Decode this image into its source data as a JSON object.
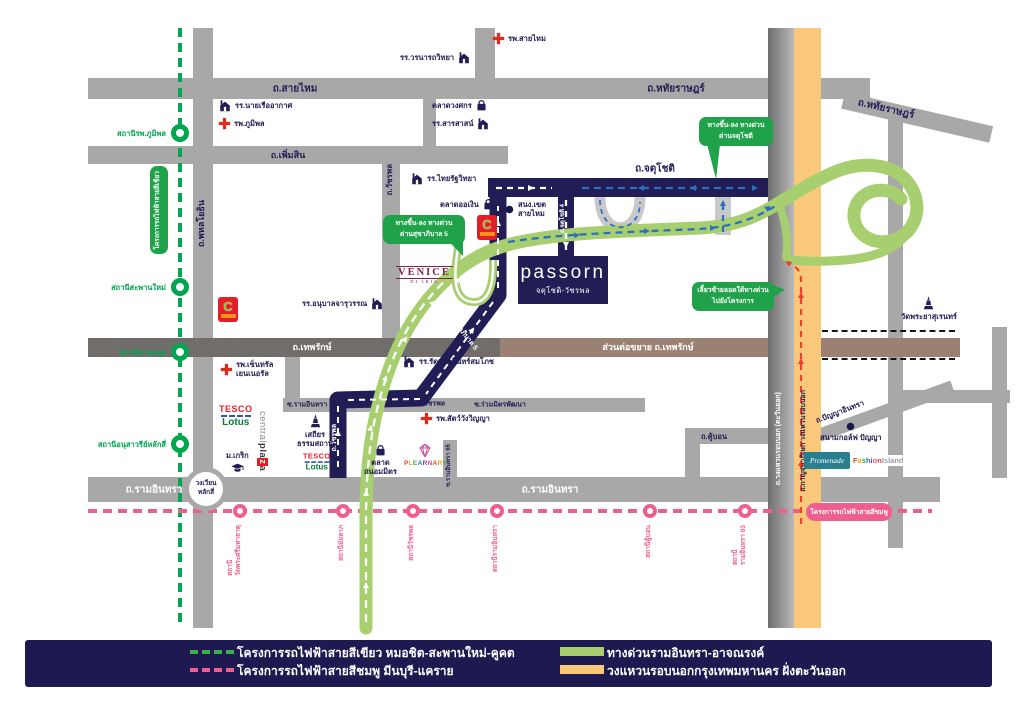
{
  "project": {
    "brand": "passorn",
    "subtitle": "จตุโชติ-วัชรพล"
  },
  "colors": {
    "navy": "#221d54",
    "roadGray": "#a8a8a8",
    "darkRoad": "#716d6a",
    "brownRoad": "#9b8173",
    "expresswayGreen": "#a8cf6f",
    "ringOrange": "#f9c87a",
    "railGreen": "#00a650",
    "pinkLine": "#ee5f8e",
    "badgeGreen": "#1fa24a",
    "routeBlue": "#2f6fc0",
    "routeRed": "#e8432c"
  },
  "legend": {
    "items": [
      {
        "swatch": "dash-green",
        "label": "โครงการรถไฟฟ้าสายสีเขียว หมอชิต-สะพานใหม่-คูคต"
      },
      {
        "swatch": "dash-pink",
        "label": "โครงการรถไฟฟ้าสายสีชมพู มีนบุรี-แคราย"
      },
      {
        "swatch": "bar-green",
        "label": "ทางด่วนรามอินทรา-อาจณรงค์"
      },
      {
        "swatch": "bar-orange",
        "label": "วงแหวนรอบนอกกรุงเทพมหานคร ฝั่งตะวันออก"
      }
    ]
  },
  "roadLabels": [
    {
      "text": "ถ.สายไหม",
      "x": 295,
      "y": 89,
      "rot": 0,
      "c": "navy",
      "s": 10
    },
    {
      "text": "ถ.หทัยราษฎร์",
      "x": 676,
      "y": 89,
      "rot": 0,
      "c": "navy",
      "s": 10
    },
    {
      "text": "ถ.หทัยราษฎร์",
      "x": 886,
      "y": 109,
      "rot": 13,
      "c": "navy",
      "s": 10
    },
    {
      "text": "ถ.เพิ่มสิน",
      "x": 288,
      "y": 155,
      "rot": 0,
      "c": "navy",
      "s": 9
    },
    {
      "text": "ถ.จตุโชติ",
      "x": 655,
      "y": 169,
      "rot": 0,
      "c": "navy",
      "s": 10
    },
    {
      "text": "ถ.เทพรักษ์",
      "x": 312,
      "y": 347,
      "rot": 0,
      "c": "white",
      "s": 9
    },
    {
      "text": "ส่วนต่อขยาย ถ.เทพรักษ์",
      "x": 648,
      "y": 347,
      "rot": 0,
      "c": "white",
      "s": 9
    },
    {
      "text": "ซ.รามอินทรา 39",
      "x": 312,
      "y": 405,
      "rot": 0,
      "c": "navy",
      "s": 7
    },
    {
      "text": "แยกวัชรพล",
      "x": 428,
      "y": 404,
      "rot": 0,
      "c": "navy",
      "s": 7
    },
    {
      "text": "ซ.ร่วมมิตรพัฒนา",
      "x": 500,
      "y": 405,
      "rot": 0,
      "c": "navy",
      "s": 7
    },
    {
      "text": "ถ.รามอินทรา",
      "x": 154,
      "y": 490,
      "rot": 0,
      "c": "white",
      "s": 10
    },
    {
      "text": "ถ.รามอินทรา",
      "x": 550,
      "y": 490,
      "rot": 0,
      "c": "white",
      "s": 10
    },
    {
      "text": "ถ.คู้บอน",
      "x": 714,
      "y": 437,
      "rot": 0,
      "c": "navy",
      "s": 7.5
    },
    {
      "text": "ถ.ปัญญาอินทรา",
      "x": 840,
      "y": 412,
      "rot": -21,
      "c": "navy",
      "s": 7.5
    },
    {
      "text": "ถ.สุขาภิบาล 5",
      "x": 463,
      "y": 333,
      "rot": 52,
      "c": "white",
      "s": 7
    }
  ],
  "vroadLabels": [
    {
      "text": "ถ.พหลโยธิน",
      "x": 196,
      "top": 200,
      "c": "navy",
      "s": 9
    },
    {
      "text": "ถ.วัชรพล",
      "x": 385,
      "top": 164,
      "c": "navy",
      "s": 8
    },
    {
      "text": "ถ.จตุโชติ 4",
      "x": 560,
      "top": 204,
      "c": "white",
      "s": 6
    },
    {
      "text": "ถ.วัชรพล",
      "x": 331,
      "top": 424,
      "c": "white",
      "s": 7
    },
    {
      "text": "ซ.รามอินทรา 65",
      "x": 446,
      "top": 444,
      "c": "navy",
      "s": 6
    },
    {
      "text": "ถ.วงแหวนรอบนอก (ตะวันออก)",
      "x": 775,
      "top": 392,
      "c": "white",
      "s": 7
    },
    {
      "text": "ถ.กาญจนาภิเษก วงแหวนรอบนอก",
      "x": 800,
      "top": 390,
      "c": "navy",
      "s": 7
    }
  ],
  "landmarks": [
    {
      "type": "hospital",
      "lines": [
        "รพ.สายไหม"
      ],
      "x": 492,
      "y": 32,
      "layout": "icon-left"
    },
    {
      "type": "school",
      "lines": [
        "รร.วรนารถวิทยา"
      ],
      "x": 400,
      "y": 51,
      "layout": "icon-right"
    },
    {
      "type": "school",
      "lines": [
        "รร.นายเรืออากาศ"
      ],
      "x": 218,
      "y": 99,
      "layout": "icon-left"
    },
    {
      "type": "hospital",
      "lines": [
        "รพ.ภูมิพล"
      ],
      "x": 218,
      "y": 117,
      "layout": "icon-left"
    },
    {
      "type": "market",
      "lines": [
        "ตลาดวงศกร"
      ],
      "x": 432,
      "y": 99,
      "layout": "icon-right"
    },
    {
      "type": "school",
      "lines": [
        "รร.สารสาสน์"
      ],
      "x": 432,
      "y": 117,
      "layout": "icon-right"
    },
    {
      "type": "school",
      "lines": [
        "รร.ไทยรัฐวิทยา"
      ],
      "x": 410,
      "y": 172,
      "layout": "icon-left"
    },
    {
      "type": "market",
      "lines": [
        "ตลาดออเงิน"
      ],
      "x": 440,
      "y": 198,
      "layout": "icon-right"
    },
    {
      "type": "dot",
      "lines": [
        "สนง.เขต",
        "สายไหม"
      ],
      "x": 504,
      "y": 200,
      "layout": "icon-left"
    },
    {
      "type": "school",
      "lines": [
        "รร.อนุบาลจารุวรรณ"
      ],
      "x": 302,
      "y": 297,
      "layout": "icon-right"
    },
    {
      "type": "hospital",
      "lines": [
        "รพ.เซ็นทรัล",
        "เยนเนอรัล"
      ],
      "x": 220,
      "y": 360,
      "layout": "icon-left"
    },
    {
      "type": "school",
      "lines": [
        "รร.รัตนโกสินทร์สมโภช"
      ],
      "x": 402,
      "y": 355,
      "layout": "icon-left"
    },
    {
      "type": "hospital",
      "lines": [
        "รพ.สัตว์วังวิญญา"
      ],
      "x": 420,
      "y": 412,
      "layout": "icon-left"
    },
    {
      "type": "temple",
      "lines": [
        "เสถียร",
        "ธรรมสถาน"
      ],
      "x": 297,
      "y": 414,
      "layout": "icon-top"
    },
    {
      "type": "university",
      "lines": [
        "ม.เกริก"
      ],
      "x": 226,
      "y": 451,
      "layout": "icon-bottom"
    },
    {
      "type": "market",
      "lines": [
        "ตลาด",
        "ถนอมมิตร"
      ],
      "x": 364,
      "y": 444,
      "layout": "icon-top"
    },
    {
      "type": "temple",
      "lines": [
        "วัดพระยาสุเรนทร์"
      ],
      "x": 901,
      "y": 296,
      "layout": "icon-top"
    },
    {
      "type": "dot",
      "lines": [
        "สนามกอล์ฟ ปัญญา"
      ],
      "x": 820,
      "y": 421,
      "layout": "icon-top"
    }
  ],
  "greenLine": {
    "name": "โครงการรถไฟฟ้าสายสีเขียว",
    "stations": [
      {
        "y": 133,
        "label": "สถานีรพ.ภูมิพล"
      },
      {
        "y": 287,
        "label": "สถานีสะพานใหม่"
      },
      {
        "y": 352,
        "label": "สถานีสายหยุด"
      },
      {
        "y": 444,
        "label": "สถานีอนุสาวรีย์หลักสี่"
      }
    ]
  },
  "pinkLine": {
    "badge": "โครงการรถไฟฟ้าสายสีชมพู",
    "stations": [
      {
        "x": 240,
        "lines": [
          "สถานี",
          "วัดพระศรีมหาธาตุ"
        ]
      },
      {
        "x": 343,
        "lines": [
          "สถานีมัยลาภ"
        ]
      },
      {
        "x": 413,
        "lines": [
          "สถานีวัชรพล"
        ]
      },
      {
        "x": 497,
        "lines": [
          "สถานีรามอินทรา"
        ]
      },
      {
        "x": 650,
        "lines": [
          "สถานีคู้บอน"
        ]
      },
      {
        "x": 745,
        "lines": [
          "สถานี",
          "รามอินทรา 83"
        ]
      }
    ]
  },
  "badges": [
    {
      "x": 383,
      "y": 215,
      "w": 82,
      "lines": [
        "ทางขึ้น-ลง ทางด่วน",
        "ด่านสุขาภิบาล 5"
      ],
      "tail": "br"
    },
    {
      "x": 699,
      "y": 117,
      "w": 74,
      "lines": [
        "ทางขึ้น-ลง ทางด่วน",
        "ด่านจตุโชติ"
      ],
      "tail": "bl"
    },
    {
      "x": 692,
      "y": 282,
      "w": 82,
      "lines": [
        "เลี้ยวซ้ายลอดใต้ทางด่วน",
        "ไปยังโครงการ"
      ],
      "tail": "tr"
    }
  ],
  "roundabout": {
    "line1": "วงเวียน",
    "line2": "หลักสี่"
  },
  "brands": {
    "bigc": {
      "label": "C"
    },
    "tesco": {
      "line1": "TESCO",
      "line2": "Lotus"
    },
    "centralplaza": {
      "part1": "central",
      "part2": "pla",
      "part3": "z",
      "part4": "a"
    },
    "venice": {
      "name": "VENICE",
      "tagline": "DI IRIS"
    },
    "plearnary": {
      "label": "PLEARNARY"
    },
    "promenade": {
      "label": "Promenade"
    },
    "fashionisland": {
      "part1": "Fashion",
      "part2": "Island"
    }
  }
}
